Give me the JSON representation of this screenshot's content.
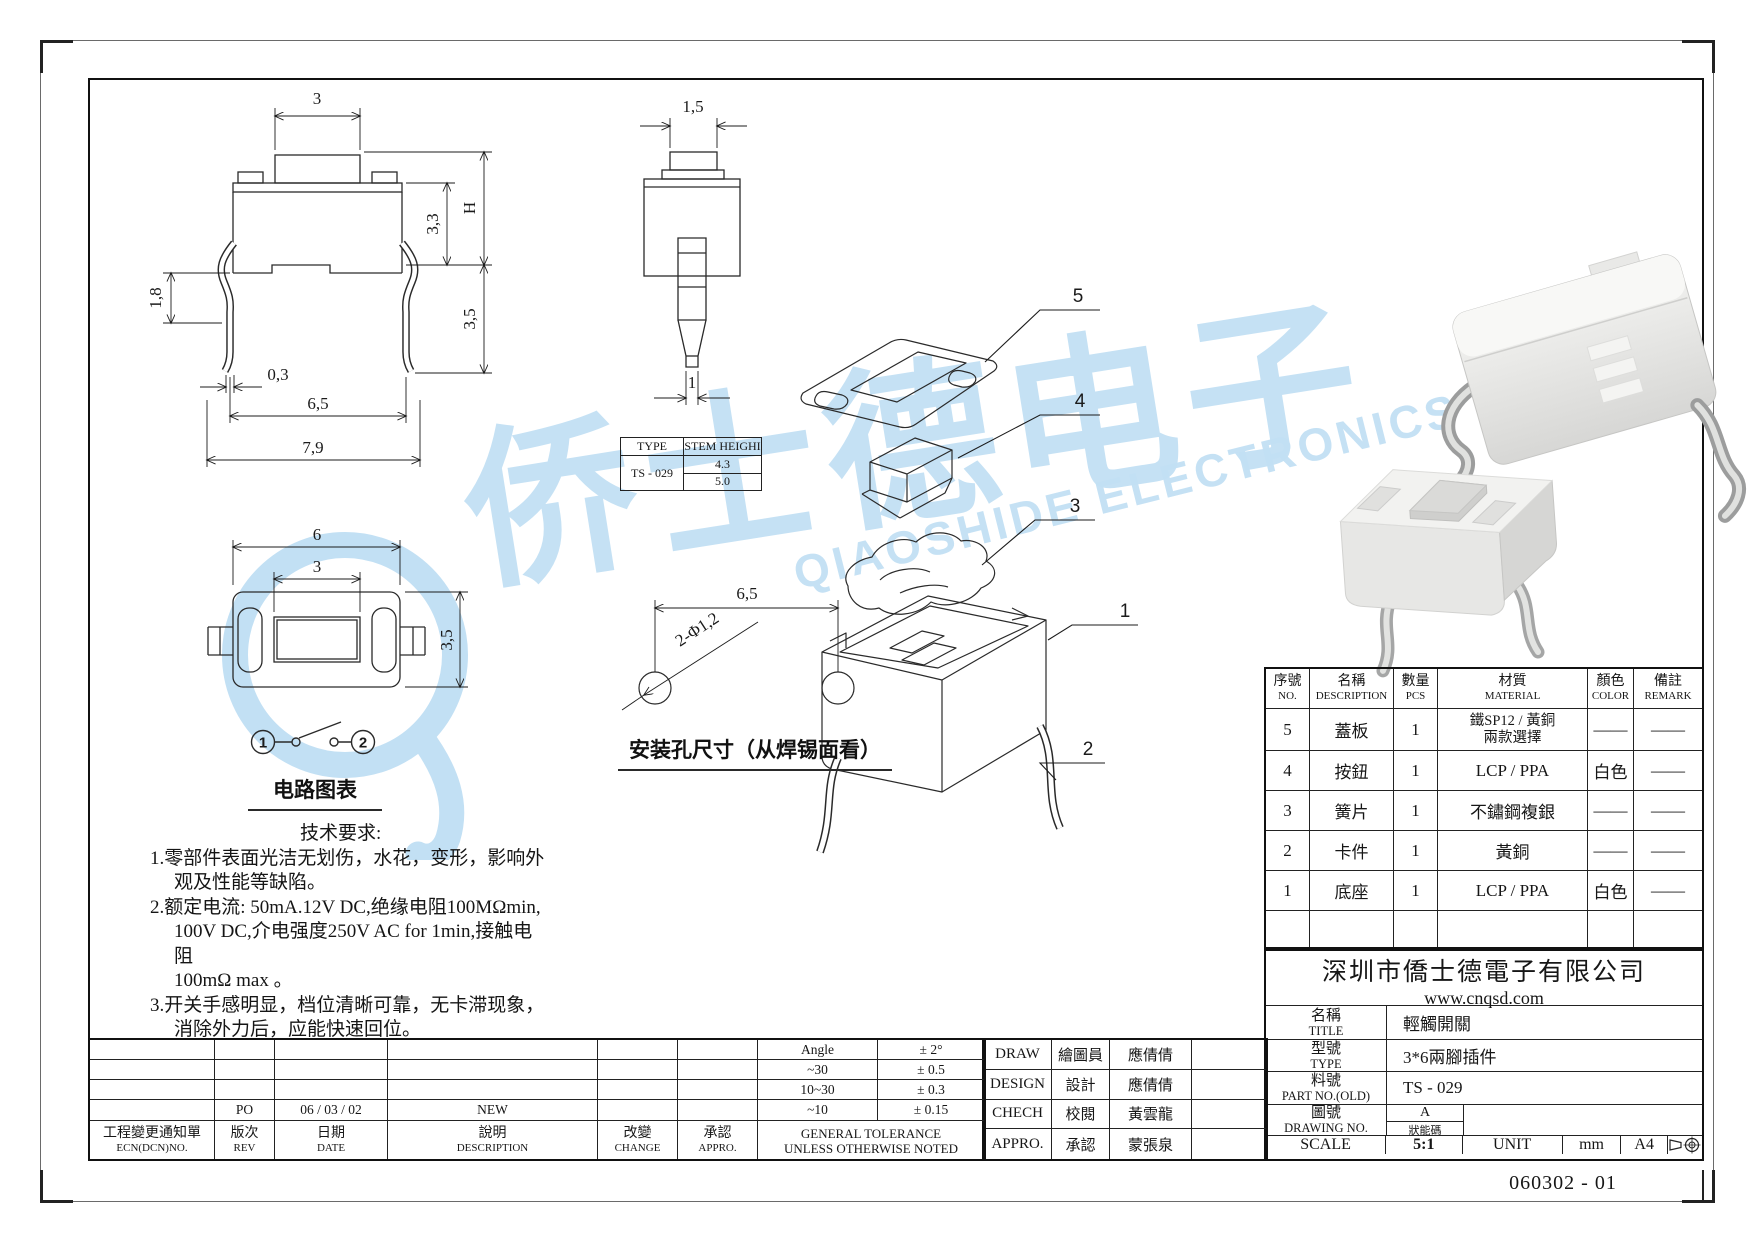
{
  "watermark": {
    "cjk": "侨士德电子",
    "latin": "QIAOSHIDE ELECTRONICS",
    "color": "#c2e0f4"
  },
  "front_view": {
    "dim_button_width": "3",
    "dim_body_height": "3,3",
    "dim_total_height": "H",
    "dim_leg_bend": "1,8",
    "dim_leg_thickness": "0,3",
    "dim_leg_pitch": "6,5",
    "dim_overall_width": "7,9",
    "dim_below_seat": "3,5"
  },
  "side_view": {
    "dim_cap_width": "1,5",
    "dim_stem_tip": "1"
  },
  "stem_table": {
    "col_type": "TYPE",
    "col_height": "STEM HEIGHI",
    "type_value": "TS - 029",
    "height1": "4.3",
    "height2": "5.0"
  },
  "top_view": {
    "dim_length": "6",
    "dim_button": "3",
    "dim_width": "3,5"
  },
  "circuit": {
    "terminal1": "1",
    "terminal2": "2",
    "label": "电路图表"
  },
  "tech": {
    "title": "技术要求:",
    "lines": [
      "1.零部件表面光洁无划伤，水花，变形，影响外",
      "观及性能等缺陷。",
      "2.额定电流: 50mA.12V DC,绝缘电阻100MΩmin,",
      "100V DC,介电强度250V AC for 1min,接触电阻",
      "100mΩ max 。",
      "3.开关手感明显，档位清晰可靠，无卡滞现象，",
      "消除外力后，应能快速回位。"
    ]
  },
  "mounting": {
    "dim_pitch": "6,5",
    "dim_holes": "2-Φ1,2",
    "label": "安装孔尺寸（从焊锡面看）"
  },
  "exploded": {
    "callout_5": "5",
    "callout_4": "4",
    "callout_3": "3",
    "callout_1": "1",
    "callout_2": "2"
  },
  "parts_table": {
    "headers": {
      "no_zh": "序號",
      "no_en": "NO.",
      "name_zh": "名稱",
      "name_en": "DESCRIPTION",
      "qty_zh": "數量",
      "qty_en": "PCS",
      "material_zh": "材質",
      "material_en": "MATERIAL",
      "color_zh": "顏色",
      "color_en": "COLOR",
      "remark_zh": "備註",
      "remark_en": "REMARK"
    },
    "rows": [
      {
        "no": "5",
        "name": "蓋板",
        "qty": "1",
        "material": "鐵SP12 / 黃銅",
        "material2": "兩款選擇",
        "color": "——",
        "remark": "——"
      },
      {
        "no": "4",
        "name": "按鈕",
        "qty": "1",
        "material": "LCP / PPA",
        "material2": "",
        "color": "白色",
        "remark": "——"
      },
      {
        "no": "3",
        "name": "簧片",
        "qty": "1",
        "material": "不鏽鋼複銀",
        "material2": "",
        "color": "——",
        "remark": "——"
      },
      {
        "no": "2",
        "name": "卡件",
        "qty": "1",
        "material": "黃銅",
        "material2": "",
        "color": "——",
        "remark": "——"
      },
      {
        "no": "1",
        "name": "底座",
        "qty": "1",
        "material": "LCP / PPA",
        "material2": "",
        "color": "白色",
        "remark": "——"
      }
    ]
  },
  "title_block": {
    "company": "深圳市僑士德電子有限公司",
    "website": "www.cnqsd.com",
    "title_zh": "名稱",
    "title_en": "TITLE",
    "title_value": "輕觸開關",
    "type_zh": "型號",
    "type_en": "TYPE",
    "type_value": "3*6兩腳插件",
    "part_zh": "料號",
    "part_en": "PART NO.(OLD)",
    "part_value": "TS - 029",
    "drawing_zh": "圖號",
    "drawing_en": "DRAWING NO.",
    "drawing_rev": "A",
    "drawing_code": "狀能碼",
    "scale_label": "SCALE",
    "scale_value": "5:1",
    "unit_label": "UNIT",
    "unit_value": "mm",
    "sheet_size": "A4"
  },
  "signatures": {
    "rows": [
      {
        "en": "DRAW",
        "zh": "繪圖員",
        "name": "應倩倩"
      },
      {
        "en": "DESIGN",
        "zh": "設計",
        "name": "應倩倩"
      },
      {
        "en": "CHECH",
        "zh": "校閱",
        "name": "黃雲龍"
      },
      {
        "en": "APPRO.",
        "zh": "承認",
        "name": "蒙張泉"
      }
    ]
  },
  "revision": {
    "ecn_zh": "工程變更通知單",
    "ecn_en": "ECN(DCN)NO.",
    "rev_zh": "版次",
    "rev_en": "REV",
    "date_zh": "日期",
    "date_en": "DATE",
    "desc_zh": "說明",
    "desc_en": "DESCRIPTION",
    "change_zh": "改變",
    "change_en": "CHANGE",
    "appro_zh": "承認",
    "appro_en": "APPRO.",
    "row_rev": "PO",
    "row_date": "06 / 03 / 02",
    "row_desc": "NEW"
  },
  "tolerance": {
    "title1": "GENERAL TOLERANCE",
    "title2": "UNLESS OTHERWISE NOTED",
    "rows": [
      {
        "range": "Angle",
        "value": "± 2°"
      },
      {
        "range": "~30",
        "value": "± 0.5"
      },
      {
        "range": "10~30",
        "value": "± 0.3"
      },
      {
        "range": "~10",
        "value": "± 0.15"
      }
    ]
  },
  "doc_number": "060302 - 01"
}
